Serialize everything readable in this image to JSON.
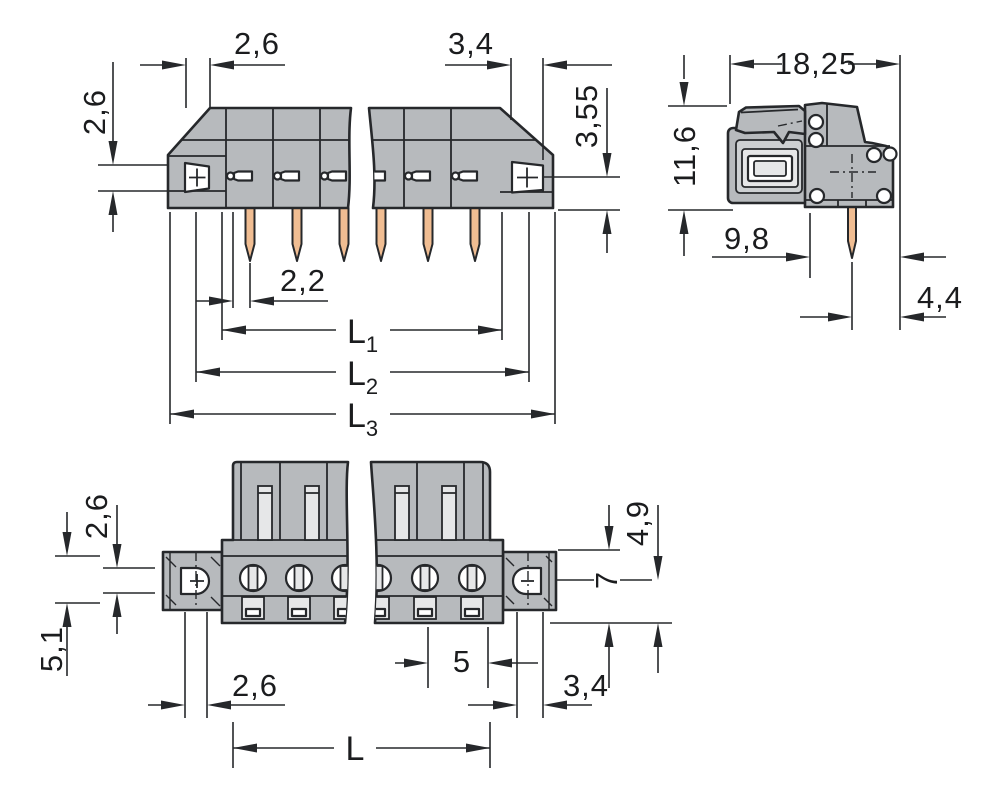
{
  "drawing": {
    "colors": {
      "background": "#ffffff",
      "body": "#b7babd",
      "body_light": "#cdd0d2",
      "cavity": "#e6e7e8",
      "white": "#ffffff",
      "pin": "#f0bd92",
      "line": "#26282b",
      "text": "#1b1c1e"
    },
    "front_view": {
      "dim_top_left": "2,6",
      "dim_top_right": "3,4",
      "dim_side_left": "2,6",
      "dim_side_right": "3,55",
      "dim_pin_offset": "2,2",
      "dim_l1": {
        "base": "L",
        "sub": "1"
      },
      "dim_l2": {
        "base": "L",
        "sub": "2"
      },
      "dim_l3": {
        "base": "L",
        "sub": "3"
      }
    },
    "side_view": {
      "dim_width": "18,25",
      "dim_height": "11,6",
      "dim_depth": "9,8",
      "dim_pin_to_edge": "4,4"
    },
    "bottom_view": {
      "dim_left_upper": "2,6",
      "dim_left_lower": "5,1",
      "dim_right_upper": "4,9",
      "dim_right_mid": "7",
      "dim_pitch": "5",
      "dim_bottom_left": "2,6",
      "dim_bottom_right": "3,4",
      "dim_length": "L"
    }
  }
}
